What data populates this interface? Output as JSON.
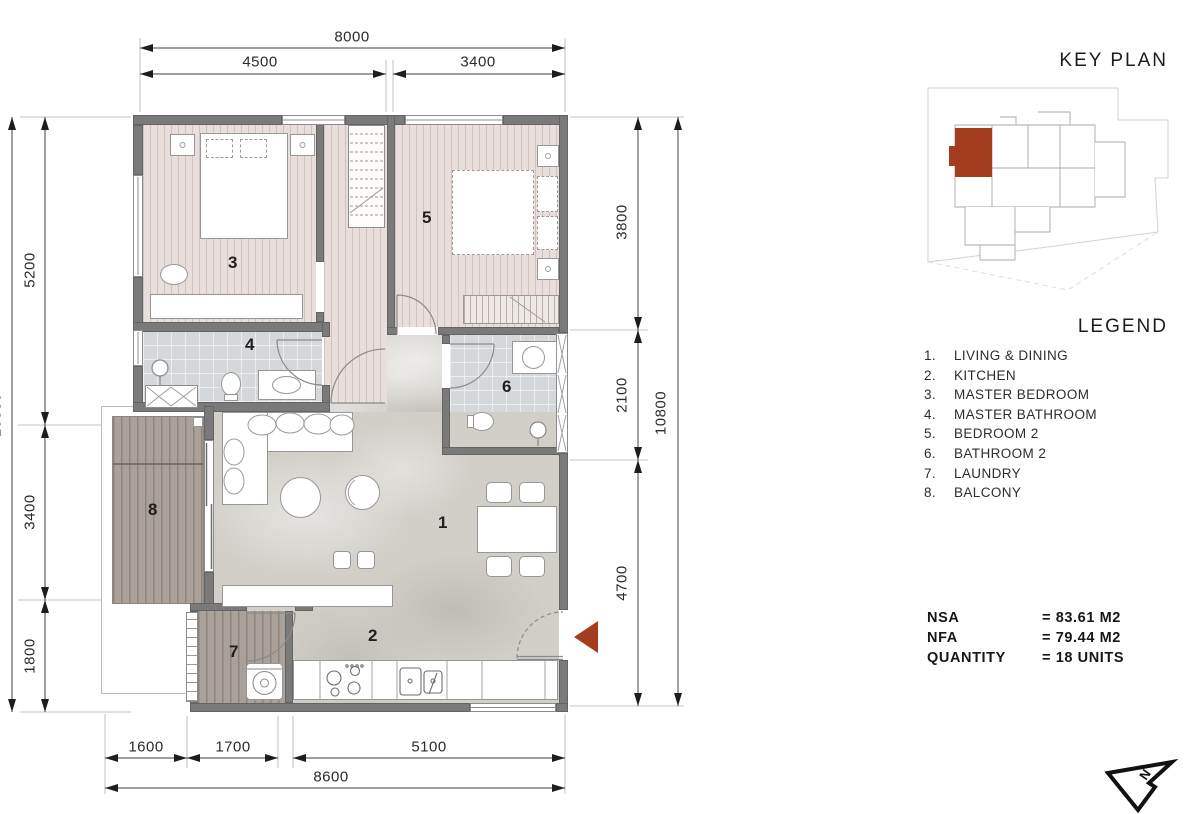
{
  "panel": {
    "key_plan_title": "KEY PLAN",
    "legend_title": "LEGEND",
    "legend_items": [
      {
        "num": "1.",
        "label": "LIVING & DINING"
      },
      {
        "num": "2.",
        "label": "KITCHEN"
      },
      {
        "num": "3.",
        "label": "MASTER BEDROOM"
      },
      {
        "num": "4.",
        "label": "MASTER BATHROOM"
      },
      {
        "num": "5.",
        "label": "BEDROOM 2"
      },
      {
        "num": "6.",
        "label": "BATHROOM 2"
      },
      {
        "num": "7.",
        "label": "LAUNDRY"
      },
      {
        "num": "8.",
        "label": "BALCONY"
      }
    ],
    "stats": [
      {
        "label": "NSA",
        "value": "= 83.61 M2"
      },
      {
        "label": "NFA",
        "value": "= 79.44 M2"
      },
      {
        "label": "QUANTITY",
        "value": "= 18 UNITS"
      }
    ],
    "north_label": "N"
  },
  "dimensions": {
    "top": {
      "total": "8000",
      "seg1": "4500",
      "seg2": "3400"
    },
    "bottom": {
      "total": "8600",
      "seg1": "1600",
      "seg2": "1700",
      "seg3": "5100"
    },
    "left": {
      "total": "10800",
      "seg1": "5200",
      "seg2": "3400",
      "seg3": "1800"
    },
    "right": {
      "total": "10800",
      "seg1": "3800",
      "seg2": "2100",
      "seg3": "4700"
    }
  },
  "rooms": {
    "living": "1",
    "kitchen": "2",
    "master_bedroom": "3",
    "master_bathroom": "4",
    "bedroom2": "5",
    "bathroom2": "6",
    "laundry": "7",
    "balcony": "8"
  },
  "colors": {
    "accent": "#A43D1D",
    "wall": "#7A7A7A"
  }
}
